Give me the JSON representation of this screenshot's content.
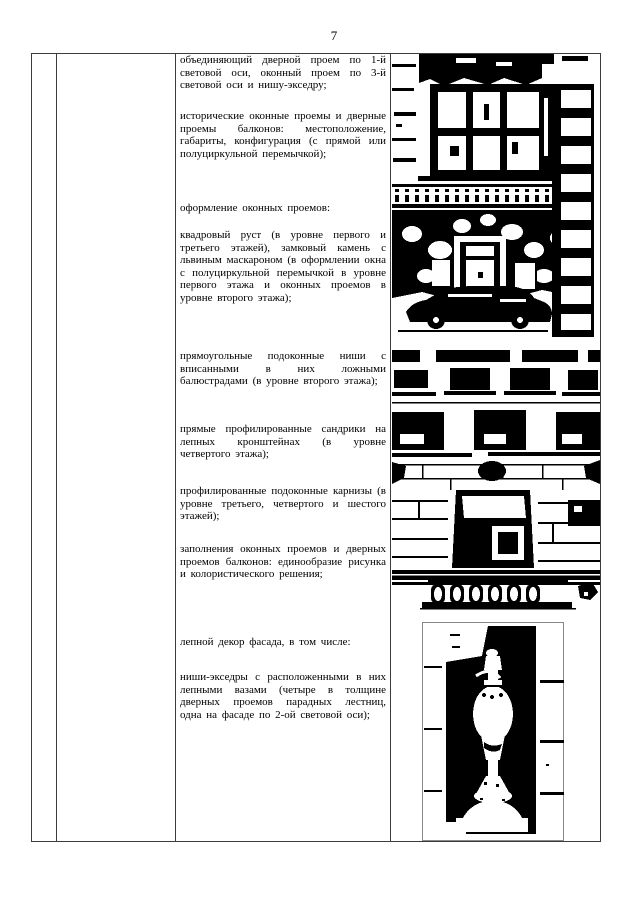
{
  "page": {
    "number": "7"
  },
  "colors": {
    "paper": "#ffffff",
    "ink": "#000000",
    "table_border": "#3c3c3c"
  },
  "table": {
    "text_column": {
      "paragraphs": [
        "объединяющий дверной проем по 1-й световой оси, оконный проем по 3-й световой оси и нишу-экседру;",
        "исторические оконные проемы и дверные проемы балконов: местоположение, габариты, конфигурация (с прямой или полуциркульной перемычкой);",
        "оформление оконных проемов:",
        "квадровый руст (в уровне первого и третьего этажей), замковый камень с львиным маскароном (в оформлении окна с полуциркульной перемычкой в уровне первого этажа и оконных проемов в уровне второго этажа);",
        "прямоугольные подоконные ниши с вписанными в них ложными балюстрадами (в уровне второго этажа);",
        "прямые профилированные сандрики на лепных кронштейнах (в уровне четвертого этажа);",
        "профилированные подоконные карнизы (в уровне третьего, четвертого и шестого этажей);",
        "заполнения оконных проемов и дверных проемов балконов: единообразие рисунка и колористического решения;",
        "лепной декор фасада, в том числе:",
        "ниши-экседры с расположенными в них лепными вазами (четыре в толщине дверных проемов парадных лестниц, одна на фасаде по 2-ой световой оси);"
      ]
    },
    "photo_column": {
      "photos": [
        "facade-window-entrance-photo",
        "facade-bottom-up-view-photo",
        "stucco-vase-in-niche-photo"
      ]
    }
  }
}
